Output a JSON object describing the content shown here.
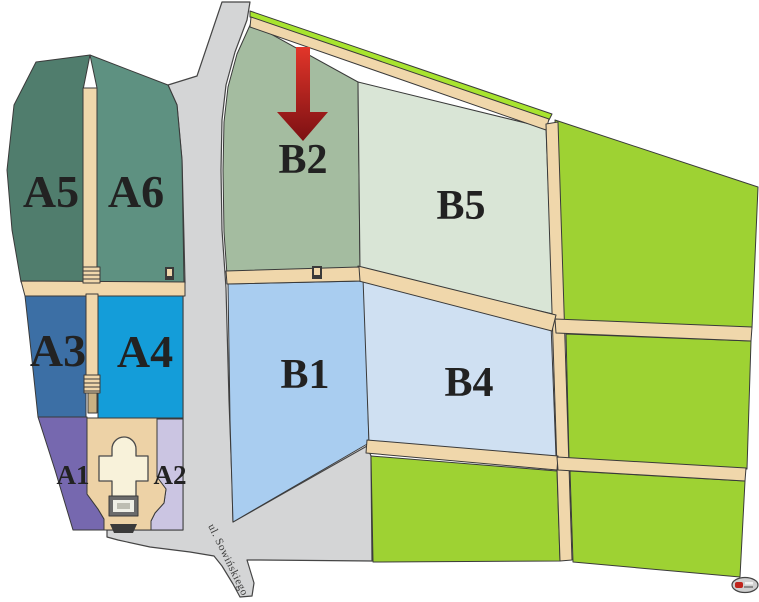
{
  "map": {
    "street": {
      "label": "ul. Sowińskiego"
    },
    "regions": {
      "a1": {
        "label": "A1",
        "color": "#7668af"
      },
      "a2": {
        "label": "A2",
        "color": "#cbc5e2"
      },
      "a3": {
        "label": "A3",
        "color": "#3c6fa5"
      },
      "a4": {
        "label": "A4",
        "color": "#149dd9"
      },
      "a5": {
        "label": "A5",
        "color": "#507d6d"
      },
      "a6": {
        "label": "A6",
        "color": "#5e9181"
      },
      "b1": {
        "label": "B1",
        "color": "#a9cdf0"
      },
      "b2": {
        "label": "B2",
        "color": "#a4bca0"
      },
      "b4": {
        "label": "B4",
        "color": "#cfe0f2"
      },
      "b5": {
        "label": "B5",
        "color": "#d9e5d6"
      }
    },
    "marker": {
      "shape": "down-arrow",
      "points_to": "B2",
      "gradient_top": "#e2362a",
      "gradient_bottom": "#7c1013"
    },
    "colors": {
      "background": "#ffffff",
      "road": "#d4d5d6",
      "path": "#f0d7ab",
      "green_area": "#9ed233",
      "green_strip": "#a8e42f",
      "plaza": "#edd2a6",
      "chapel": "#f8f2da",
      "steps_outer": "#6b6b6b",
      "steps_inner": "#efefe6",
      "gate_dark": "#3a3a3a",
      "label": "#222222",
      "street_label": "#3c3c3c",
      "logo_body": "#cfcfcf",
      "logo_accent": "#c0241c"
    }
  }
}
